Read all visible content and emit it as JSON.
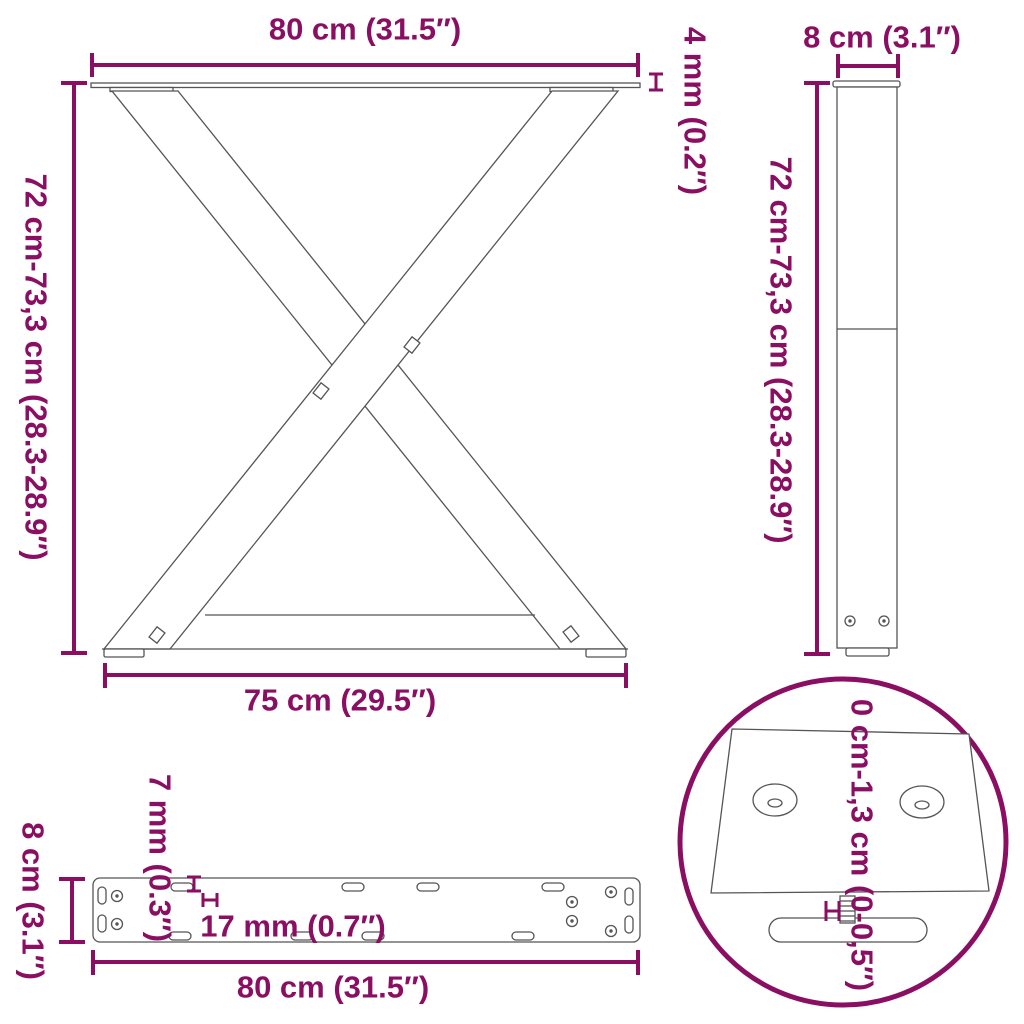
{
  "title": "Table legs dimension diagram",
  "colors": {
    "dimension_accent": "#8A0F63",
    "line_art": "#555555",
    "background": "#FFFFFF"
  },
  "views": {
    "front_view": {
      "name": "x-frame-front-view",
      "top_width": "80 cm (31.5″)",
      "height_range": "72 cm-73,3 cm (28.3-28.9″)",
      "top_plate_thickness": "4 mm (0.2″)",
      "bottom_width": "75 cm (29.5″)"
    },
    "side_view": {
      "name": "leg-side-profile-view",
      "depth": "8 cm (3.1″)",
      "height_range": "72 cm-73,3 cm (28.3-28.9″)"
    },
    "mounting_plate_view": {
      "name": "mounting-plate-top-view",
      "depth": "8 cm (3.1″)",
      "small_hole_width": "7 mm (0.3″)",
      "large_hole_width": "17 mm (0.7″)",
      "length": "80 cm (31.5″)"
    },
    "foot_detail_view": {
      "name": "adjustable-foot-detail",
      "height_adjustment": "0 cm-1,3 cm (0-0,5″)"
    }
  }
}
